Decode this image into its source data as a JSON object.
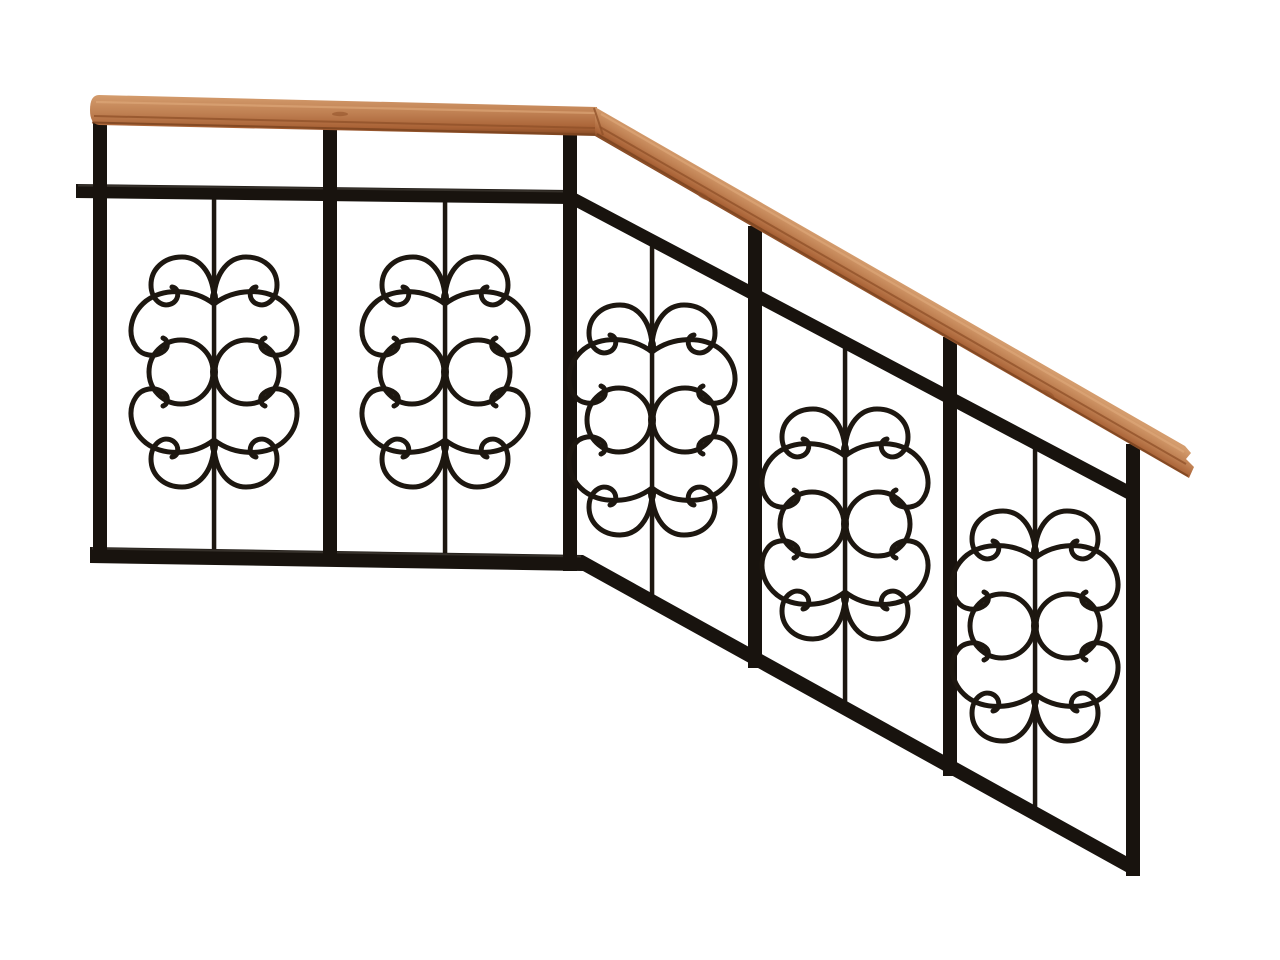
{
  "scene": {
    "description": "Wrought-iron stair railing section with a wooden handrail: two level ornamental panels, a bend, and three panels stepping down a stair slope, shown on a plain white background",
    "object_type": "stair-railing",
    "handrail_material": "wood",
    "frame_material": "wrought-iron",
    "panel_count": 5,
    "post_count": 6,
    "sections": {
      "horizontal_panels": 2,
      "sloped_panels": 3
    },
    "ornament": {
      "motif": "mirrored C-scrolls with twin center rings on a vertical bar",
      "scrolls_per_panel": 8,
      "rings_per_panel": 2
    }
  },
  "colors": {
    "wood-light": "#d49c6d",
    "wood-mid": "#c08153",
    "wood-deep": "#a96236",
    "wood-edge": "#7a431f",
    "wood-groove": "#8f5028",
    "wood-highlight": "#dfaa7c",
    "metal": "#18130e",
    "metal-sheen": "#4e4942",
    "ornament": "#1d1710",
    "background": "#ffffff"
  }
}
